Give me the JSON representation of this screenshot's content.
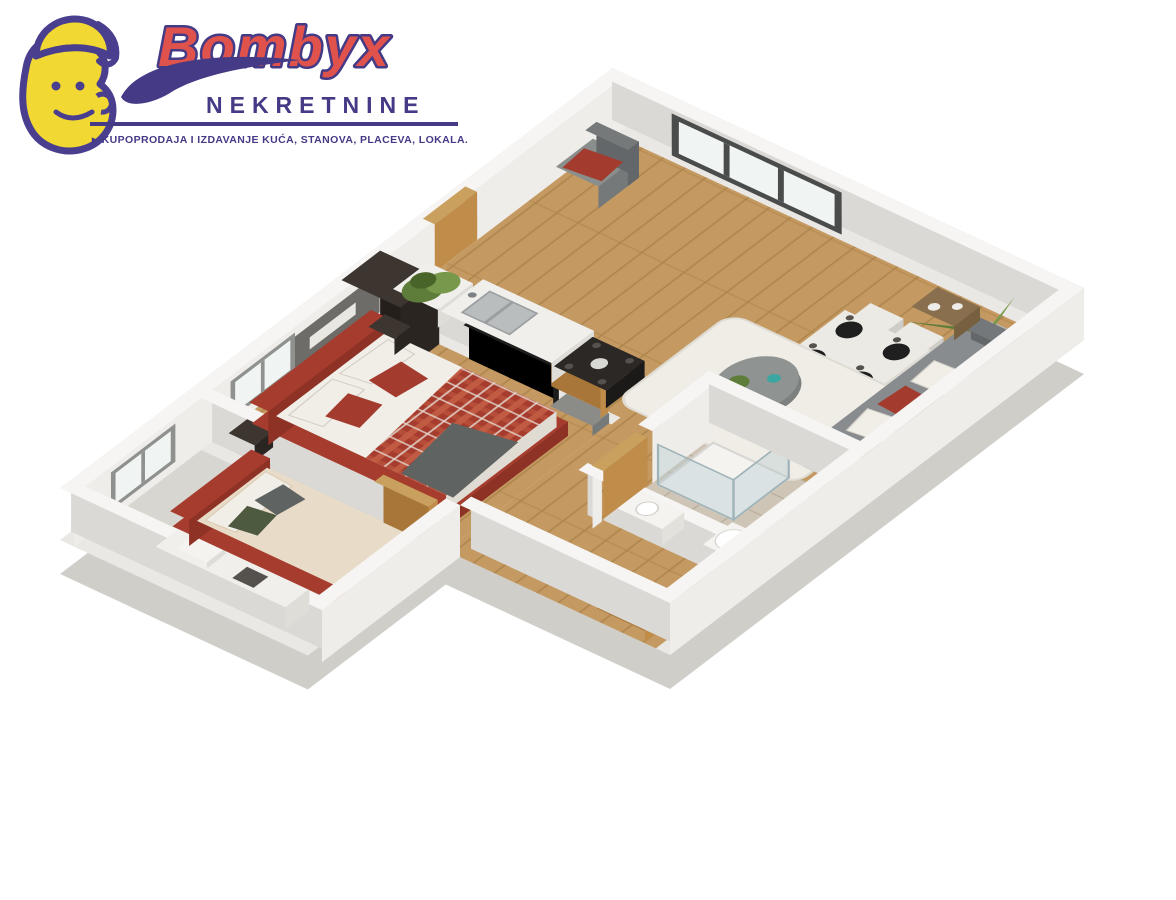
{
  "logo": {
    "brand": "Bombyx",
    "subtitle": "NEKRETNINE",
    "arrow": "▸",
    "tagline": "KUPOPRODAJA I IZDAVANJE KUĆA, STANOVA, PLACEVA, LOKALA.",
    "colors": {
      "brand_fill": "#e0524c",
      "purple": "#443a86",
      "mascot_yellow": "#f2d832",
      "mascot_outline": "#4a3f8f"
    }
  },
  "scene": {
    "type": "3d-isometric-floor-plan",
    "rooms": [
      "bedroom-1",
      "bedroom-2",
      "kitchen",
      "entrance-hall",
      "living-dining-room",
      "bathroom",
      "hallway"
    ],
    "furniture": [
      "double-bed",
      "single-bed",
      "nightstands",
      "wardrobe",
      "tv-panel",
      "desk",
      "kitchen-counter",
      "sink",
      "cooktop",
      "planter-box",
      "entrance-armchair",
      "dining-table",
      "dining-chairs",
      "place-settings",
      "palm-plant",
      "rug",
      "coffee-table",
      "sofa",
      "cushions",
      "side-table",
      "shower",
      "toilet",
      "wash-cabinet",
      "wooden-doors"
    ]
  },
  "colors": {
    "background": "#ffffff",
    "slab": "#d0cec9",
    "floor_base": "#eae8e4",
    "wall_top": "#f6f5f3",
    "wall_face": "#efedea",
    "wall_side": "#dbd9d5",
    "wood": "#c49a62",
    "wood_line": "#aa8148",
    "grey_floor": "#d8d6d1",
    "tile": "#cfc5b6",
    "tile_line": "#b9ae9d",
    "window_frame": "#8f918f",
    "window_frame_dark": "#4a4c4c",
    "glass": "#f0f4f3",
    "door_wood": "#c08c4a",
    "door_wood_dark": "#a87638",
    "door_wood_top": "#caa05f",
    "bed_red": "#a63c2e",
    "bed_red_dark": "#8f3226",
    "bed_red_side": "#7c2b20",
    "plaid_light": "#c05a42",
    "plaid_line": "#e6dcd2",
    "linen_white": "#f1eee8",
    "linen_shade": "#e0dcd4",
    "linen_side": "#d2cec6",
    "beige": "#e8dcc8",
    "beige_shade": "#d9cbb2",
    "pillow_green": "#4e5a40",
    "grey_throw": "#5f6462",
    "dark_wood": "#3c3530",
    "dark_wood_side": "#2b2521",
    "tv_black": "#1d1d1d",
    "media_grey": "#8b8b88",
    "counter": "#f0efec",
    "counter_side": "#dfddd8",
    "steel": "#b9bdbe",
    "cooktop": "#2b2825",
    "plant_green": "#5e7d3a",
    "plant_green_light": "#78994b",
    "plant_green_dark": "#496428",
    "plant_pot": "#b8b4ac",
    "chair_grey": "#8a8e8c",
    "chair_grey_dark": "#75797a",
    "table_top": "#eceae5",
    "setting_dark": "#1f1f1f",
    "sofa": "#888c8e",
    "sofa_dark": "#74787a",
    "sofa_side": "#63676a",
    "pillow_red": "#a33c2f",
    "rug": "#f0ede7",
    "rug_edge": "#dfdcd4",
    "coffee_table": "#8f9392",
    "coffee_table_dark": "#7c807f",
    "teal": "#3aa7a0",
    "shower_glass": "rgba(176,200,206,0.38)",
    "shower_glass_edge": "#9fb3b8",
    "porcelain": "#f4f3f0",
    "sign_white": "#e9e7e1",
    "headboard_panel": "#6e6c68"
  }
}
